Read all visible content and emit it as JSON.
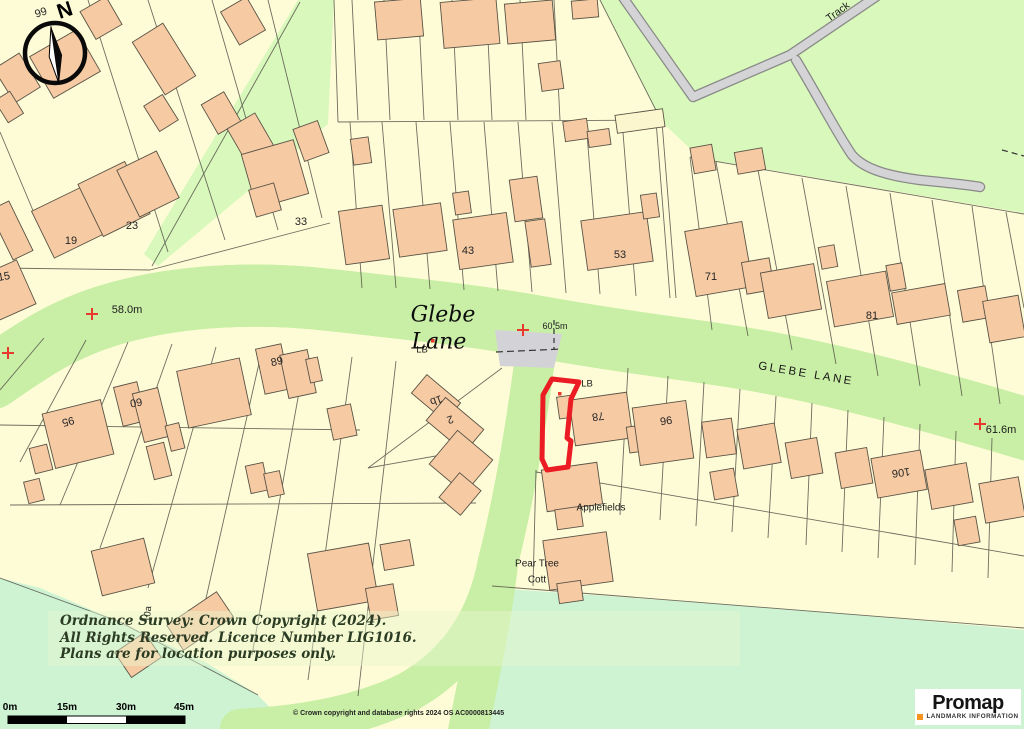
{
  "map": {
    "labels": [
      {
        "text": "99",
        "x": 41,
        "y": 13,
        "rot": -18,
        "cls": "num",
        "name": "house-number-99"
      },
      {
        "text": "N",
        "x": 65,
        "y": 11,
        "rot": -18,
        "cls": "compass-n",
        "name": "compass-north-label"
      },
      {
        "text": "15",
        "x": 4,
        "y": 277,
        "rot": -10,
        "cls": "num",
        "name": "house-number-15"
      },
      {
        "text": "19",
        "x": 71,
        "y": 241,
        "rot": 0,
        "cls": "num",
        "name": "house-number-19"
      },
      {
        "text": "23",
        "x": 132,
        "y": 226,
        "rot": 0,
        "cls": "num",
        "name": "house-number-23"
      },
      {
        "text": "33",
        "x": 301,
        "y": 222,
        "rot": 0,
        "cls": "num",
        "name": "house-number-33"
      },
      {
        "text": "43",
        "x": 468,
        "y": 251,
        "rot": 0,
        "cls": "num",
        "name": "house-number-43"
      },
      {
        "text": "53",
        "x": 620,
        "y": 255,
        "rot": 0,
        "cls": "num",
        "name": "house-number-53"
      },
      {
        "text": "71",
        "x": 711,
        "y": 277,
        "rot": 0,
        "cls": "num",
        "name": "house-number-71"
      },
      {
        "text": "81",
        "x": 872,
        "y": 316,
        "rot": 0,
        "cls": "num",
        "name": "house-number-81"
      },
      {
        "text": "95",
        "x": 68,
        "y": 421,
        "rot": 165,
        "cls": "num",
        "name": "house-number-95"
      },
      {
        "text": "60",
        "x": 136,
        "y": 402,
        "rot": 170,
        "cls": "num",
        "name": "house-number-60"
      },
      {
        "text": "89",
        "x": 277,
        "y": 362,
        "rot": -12,
        "cls": "num",
        "name": "house-number-89"
      },
      {
        "text": "1b",
        "x": 436,
        "y": 400,
        "rot": 160,
        "cls": "num",
        "name": "house-number-1b"
      },
      {
        "text": "2",
        "x": 450,
        "y": 419,
        "rot": 160,
        "cls": "num",
        "name": "house-number-2"
      },
      {
        "text": "78",
        "x": 598,
        "y": 416,
        "rot": 172,
        "cls": "num",
        "name": "house-number-78"
      },
      {
        "text": "96",
        "x": 666,
        "y": 420,
        "rot": 172,
        "cls": "num",
        "name": "house-number-96"
      },
      {
        "text": "106",
        "x": 901,
        "y": 472,
        "rot": 172,
        "cls": "num",
        "name": "house-number-106"
      },
      {
        "text": "10a",
        "x": 148,
        "y": 614,
        "rot": -85,
        "cls": "num-sm",
        "name": "house-number-10a"
      },
      {
        "text": "58.0m",
        "x": 127,
        "y": 310,
        "rot": 0,
        "cls": "bench",
        "name": "benchmark-58-0m"
      },
      {
        "text": "60.5m",
        "x": 555,
        "y": 326,
        "rot": 0,
        "cls": "bench-sm",
        "name": "benchmark-60-5m"
      },
      {
        "text": "61.6m",
        "x": 1001,
        "y": 430,
        "rot": 0,
        "cls": "bench",
        "name": "benchmark-61-6m"
      },
      {
        "text": "LB",
        "x": 422,
        "y": 350,
        "rot": 0,
        "cls": "lb",
        "name": "letter-box-label"
      },
      {
        "text": "LB",
        "x": 587,
        "y": 384,
        "rot": 0,
        "cls": "lb",
        "name": "letter-box-label"
      },
      {
        "text": "Glebe",
        "x": 443,
        "y": 315,
        "rot": 0,
        "cls": "road-serif",
        "name": "road-label-glebe"
      },
      {
        "text": "Lane",
        "x": 439,
        "y": 342,
        "rot": 0,
        "cls": "road-serif",
        "name": "road-label-lane"
      },
      {
        "text": "GLEBE LANE",
        "x": 806,
        "y": 374,
        "rot": 9.5,
        "cls": "road-caps",
        "name": "road-label-glebe-lane"
      },
      {
        "text": "Track",
        "x": 838,
        "y": 12,
        "rot": -36,
        "cls": "place",
        "name": "track-label"
      },
      {
        "text": "Applefields",
        "x": 601,
        "y": 508,
        "rot": 0,
        "cls": "place-sm",
        "name": "applefields-label"
      },
      {
        "text": "Pear Tree",
        "x": 537,
        "y": 564,
        "rot": 0,
        "cls": "place-sm",
        "name": "pear-tree-cott-label"
      },
      {
        "text": "Cott",
        "x": 537,
        "y": 580,
        "rot": 0,
        "cls": "place-sm",
        "name": "pear-tree-cott-label"
      }
    ],
    "copyright": {
      "lines": [
        "Ordnance Survey: Crown Copyright (2024).",
        "All Rights Reserved. Licence Number LIG1016.",
        "Plans are for location purposes only."
      ]
    },
    "attribution": "© Crown copyright and database rights 2024 OS AC0000813445",
    "scale_bar": {
      "labels": [
        "0m",
        "15m",
        "30m",
        "45m"
      ]
    },
    "logo": {
      "name": "Promap",
      "tagline": "LANDMARK INFORMATION"
    },
    "colors": {
      "plot_outline": "#EC1C24",
      "benchmark_red": "#E8392E",
      "building_fill": "#F6CBA4",
      "parcel_fill": "#FEFCD6",
      "road_fill": "#D3D3D7",
      "verge_khaki": "#C1C193",
      "verge_green": "#C9EFA6",
      "green_open": "#D9F8BC",
      "green_meadow": "#CDF3D3",
      "scale_orange": "#F7941E"
    }
  }
}
